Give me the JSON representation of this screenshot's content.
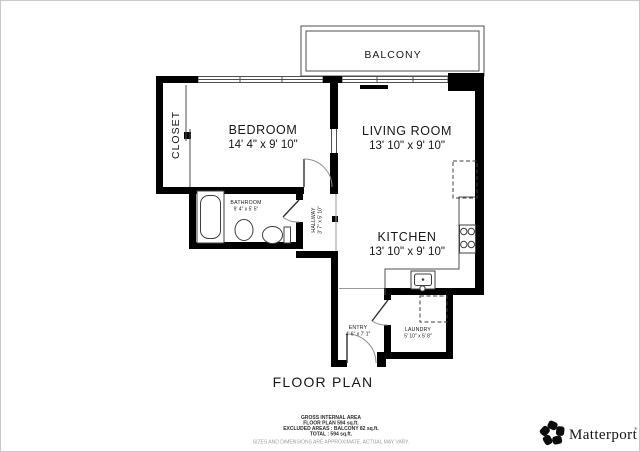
{
  "plan": {
    "title": "FLOOR PLAN",
    "balcony": "BALCONY",
    "rooms": {
      "bedroom": {
        "name": "BEDROOM",
        "dims": "14' 4\" x 9' 10\""
      },
      "living": {
        "name": "LIVING ROOM",
        "dims": "13' 10\" x 9' 10\""
      },
      "kitchen": {
        "name": "KITCHEN",
        "dims": "13' 10\" x 9' 10\""
      },
      "closet": {
        "name": "CLOSET"
      },
      "bathroom": {
        "name": "BATHROOM",
        "dims": "9' 4\" x 5' 5\""
      },
      "hallway": {
        "name": "HALLWAY",
        "dims": "3' 7\" x 5' 10\""
      },
      "entry": {
        "name": "ENTRY",
        "dims": "4' 6\" x 7' 1\""
      },
      "laundry": {
        "name": "LAUNDRY",
        "dims": "5' 10\" x 5' 8\""
      }
    }
  },
  "footer": {
    "area_title": "GROSS INTERNAL AREA",
    "floor_plan_area": "FLOOR PLAN 594 sq.ft.",
    "excluded": "EXCLUDED AREAS : BALCONY 82 sq.ft.",
    "total": "TOTAL : 594 sq.ft.",
    "disclaimer": "SIZES AND DIMENSIONS ARE APPROXIMATE, ACTUAL MAY VARY."
  },
  "brand": {
    "name": "Matterport",
    "registered": "®"
  },
  "colors": {
    "wall": "#000000",
    "background": "#ffffff",
    "thin_line": "#4f4f4f",
    "disclaimer_text": "#9c9c9c"
  }
}
